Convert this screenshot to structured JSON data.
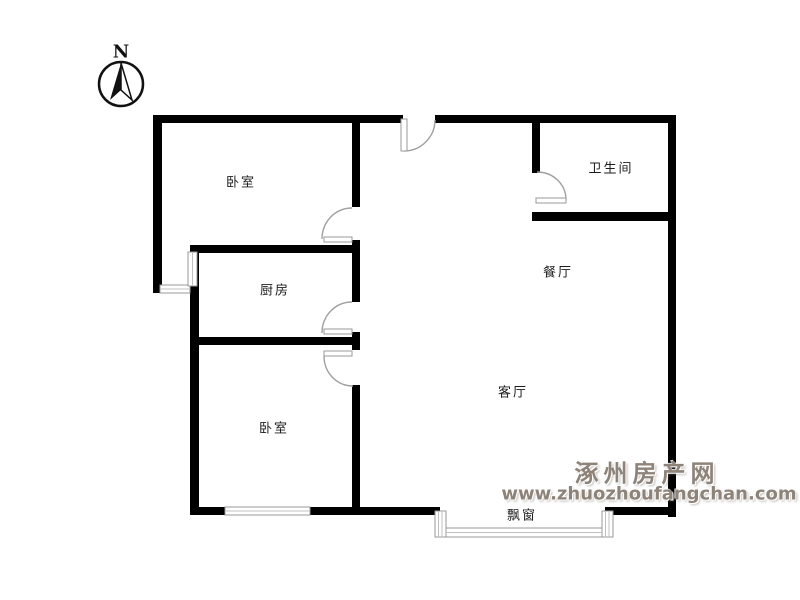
{
  "compass": {
    "label": "N"
  },
  "rooms": [
    {
      "name": "bedroom-top",
      "label": "卧室"
    },
    {
      "name": "bathroom",
      "label": "卫生间"
    },
    {
      "name": "kitchen",
      "label": "厨房"
    },
    {
      "name": "dining-room",
      "label": "餐厅"
    },
    {
      "name": "living-room",
      "label": "客厅"
    },
    {
      "name": "bedroom-bottom",
      "label": "卧室"
    },
    {
      "name": "bay-window",
      "label": "飘窗"
    }
  ],
  "watermark": {
    "site_name": "涿州房产网",
    "site_url": "www.zhuozhoufangchan.com"
  },
  "colors": {
    "wall": "#000000",
    "door_arc": "#a0a0a0",
    "window_frame": "#999999",
    "window_fill": "#e8e8e8",
    "label_text": "#1c1c1c",
    "watermark_text": "#8d8379",
    "background": "#ffffff"
  }
}
